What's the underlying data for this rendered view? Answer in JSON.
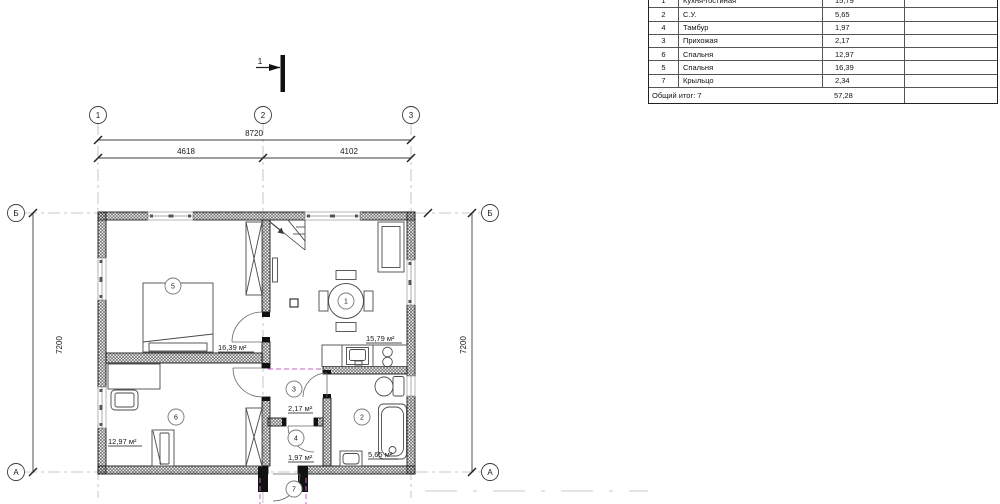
{
  "axes": {
    "a1": "1",
    "a2": "2",
    "a3": "3",
    "row_b": "Б",
    "row_a": "А"
  },
  "dims": {
    "total": "8720",
    "left_span": "4618",
    "right_span": "4102",
    "height": "7200"
  },
  "section_mark": {
    "label": "1"
  },
  "rooms": {
    "r1": {
      "num": "1",
      "area": "15,79 м²"
    },
    "r2": {
      "num": "2",
      "area": "5,65 м²"
    },
    "r3": {
      "num": "3",
      "area": "2,17 м²"
    },
    "r4": {
      "num": "4",
      "area": "1,97 м²"
    },
    "r5": {
      "num": "5",
      "area": "16,39 м²"
    },
    "r6": {
      "num": "6",
      "area": "12,97 м²"
    },
    "r7": {
      "num": "7"
    }
  },
  "table": {
    "rows": [
      {
        "num": "1",
        "name": "Кухня-гостиная",
        "area": "15,79"
      },
      {
        "num": "2",
        "name": "С.У.",
        "area": "5,65"
      },
      {
        "num": "4",
        "name": "Тамбур",
        "area": "1,97"
      },
      {
        "num": "3",
        "name": "Прихожая",
        "area": "2,17"
      },
      {
        "num": "6",
        "name": "Спальня",
        "area": "12,97"
      },
      {
        "num": "5",
        "name": "Спальня",
        "area": "16,39"
      },
      {
        "num": "7",
        "name": "Крыльцо",
        "area": "2,34"
      }
    ],
    "footer": {
      "label": "Общий итог: 7",
      "total": "57,28"
    }
  },
  "colors": {
    "magenta": "#c45fc4",
    "hatch": "#333333",
    "line": "#444444"
  }
}
